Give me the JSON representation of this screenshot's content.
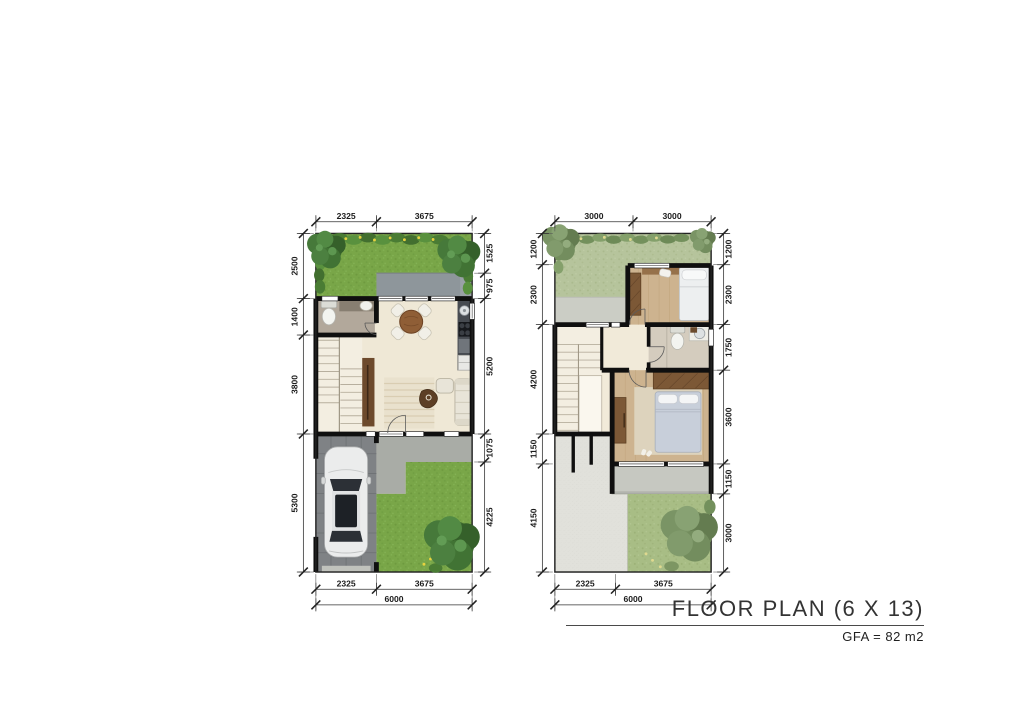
{
  "title_block": {
    "title": "FLOOR PLAN (6 X 13)",
    "subtitle": "GFA = 82 m2"
  },
  "plans": [
    {
      "label": "first-floor",
      "dims": {
        "top": [
          "2325",
          "3675"
        ],
        "left": [
          "2500",
          "1400",
          "3800",
          "5300"
        ],
        "right": [
          "1525",
          "975",
          "5200",
          "1075",
          "4225"
        ],
        "bottom": [
          "2325",
          "3675"
        ],
        "total_width": "6000"
      }
    },
    {
      "label": "second-floor",
      "dims": {
        "top": [
          "3000",
          "3000"
        ],
        "left": [
          "1200",
          "2300",
          "4200",
          "1150",
          "4150"
        ],
        "right": [
          "1200",
          "2300",
          "1750",
          "3600",
          "1150",
          "3000"
        ],
        "bottom": [
          "2325",
          "3675"
        ],
        "total_width": "6000"
      }
    }
  ],
  "colors": {
    "lawn_green": "#79a648",
    "lawn_muted": "#b6c49c",
    "lawn_muted_dark": "#a8bd85",
    "wall_black": "#0f0f0f",
    "floor_cream": "#efe8d6",
    "wood_floor": "#cdb38f",
    "roof_speckle_gray": "#e1e1db",
    "carport_gray": "#7f8285",
    "porch_gray": "#8e969b",
    "wood_furniture": "#7c5836",
    "flower_yellow": "#e6d23f"
  }
}
